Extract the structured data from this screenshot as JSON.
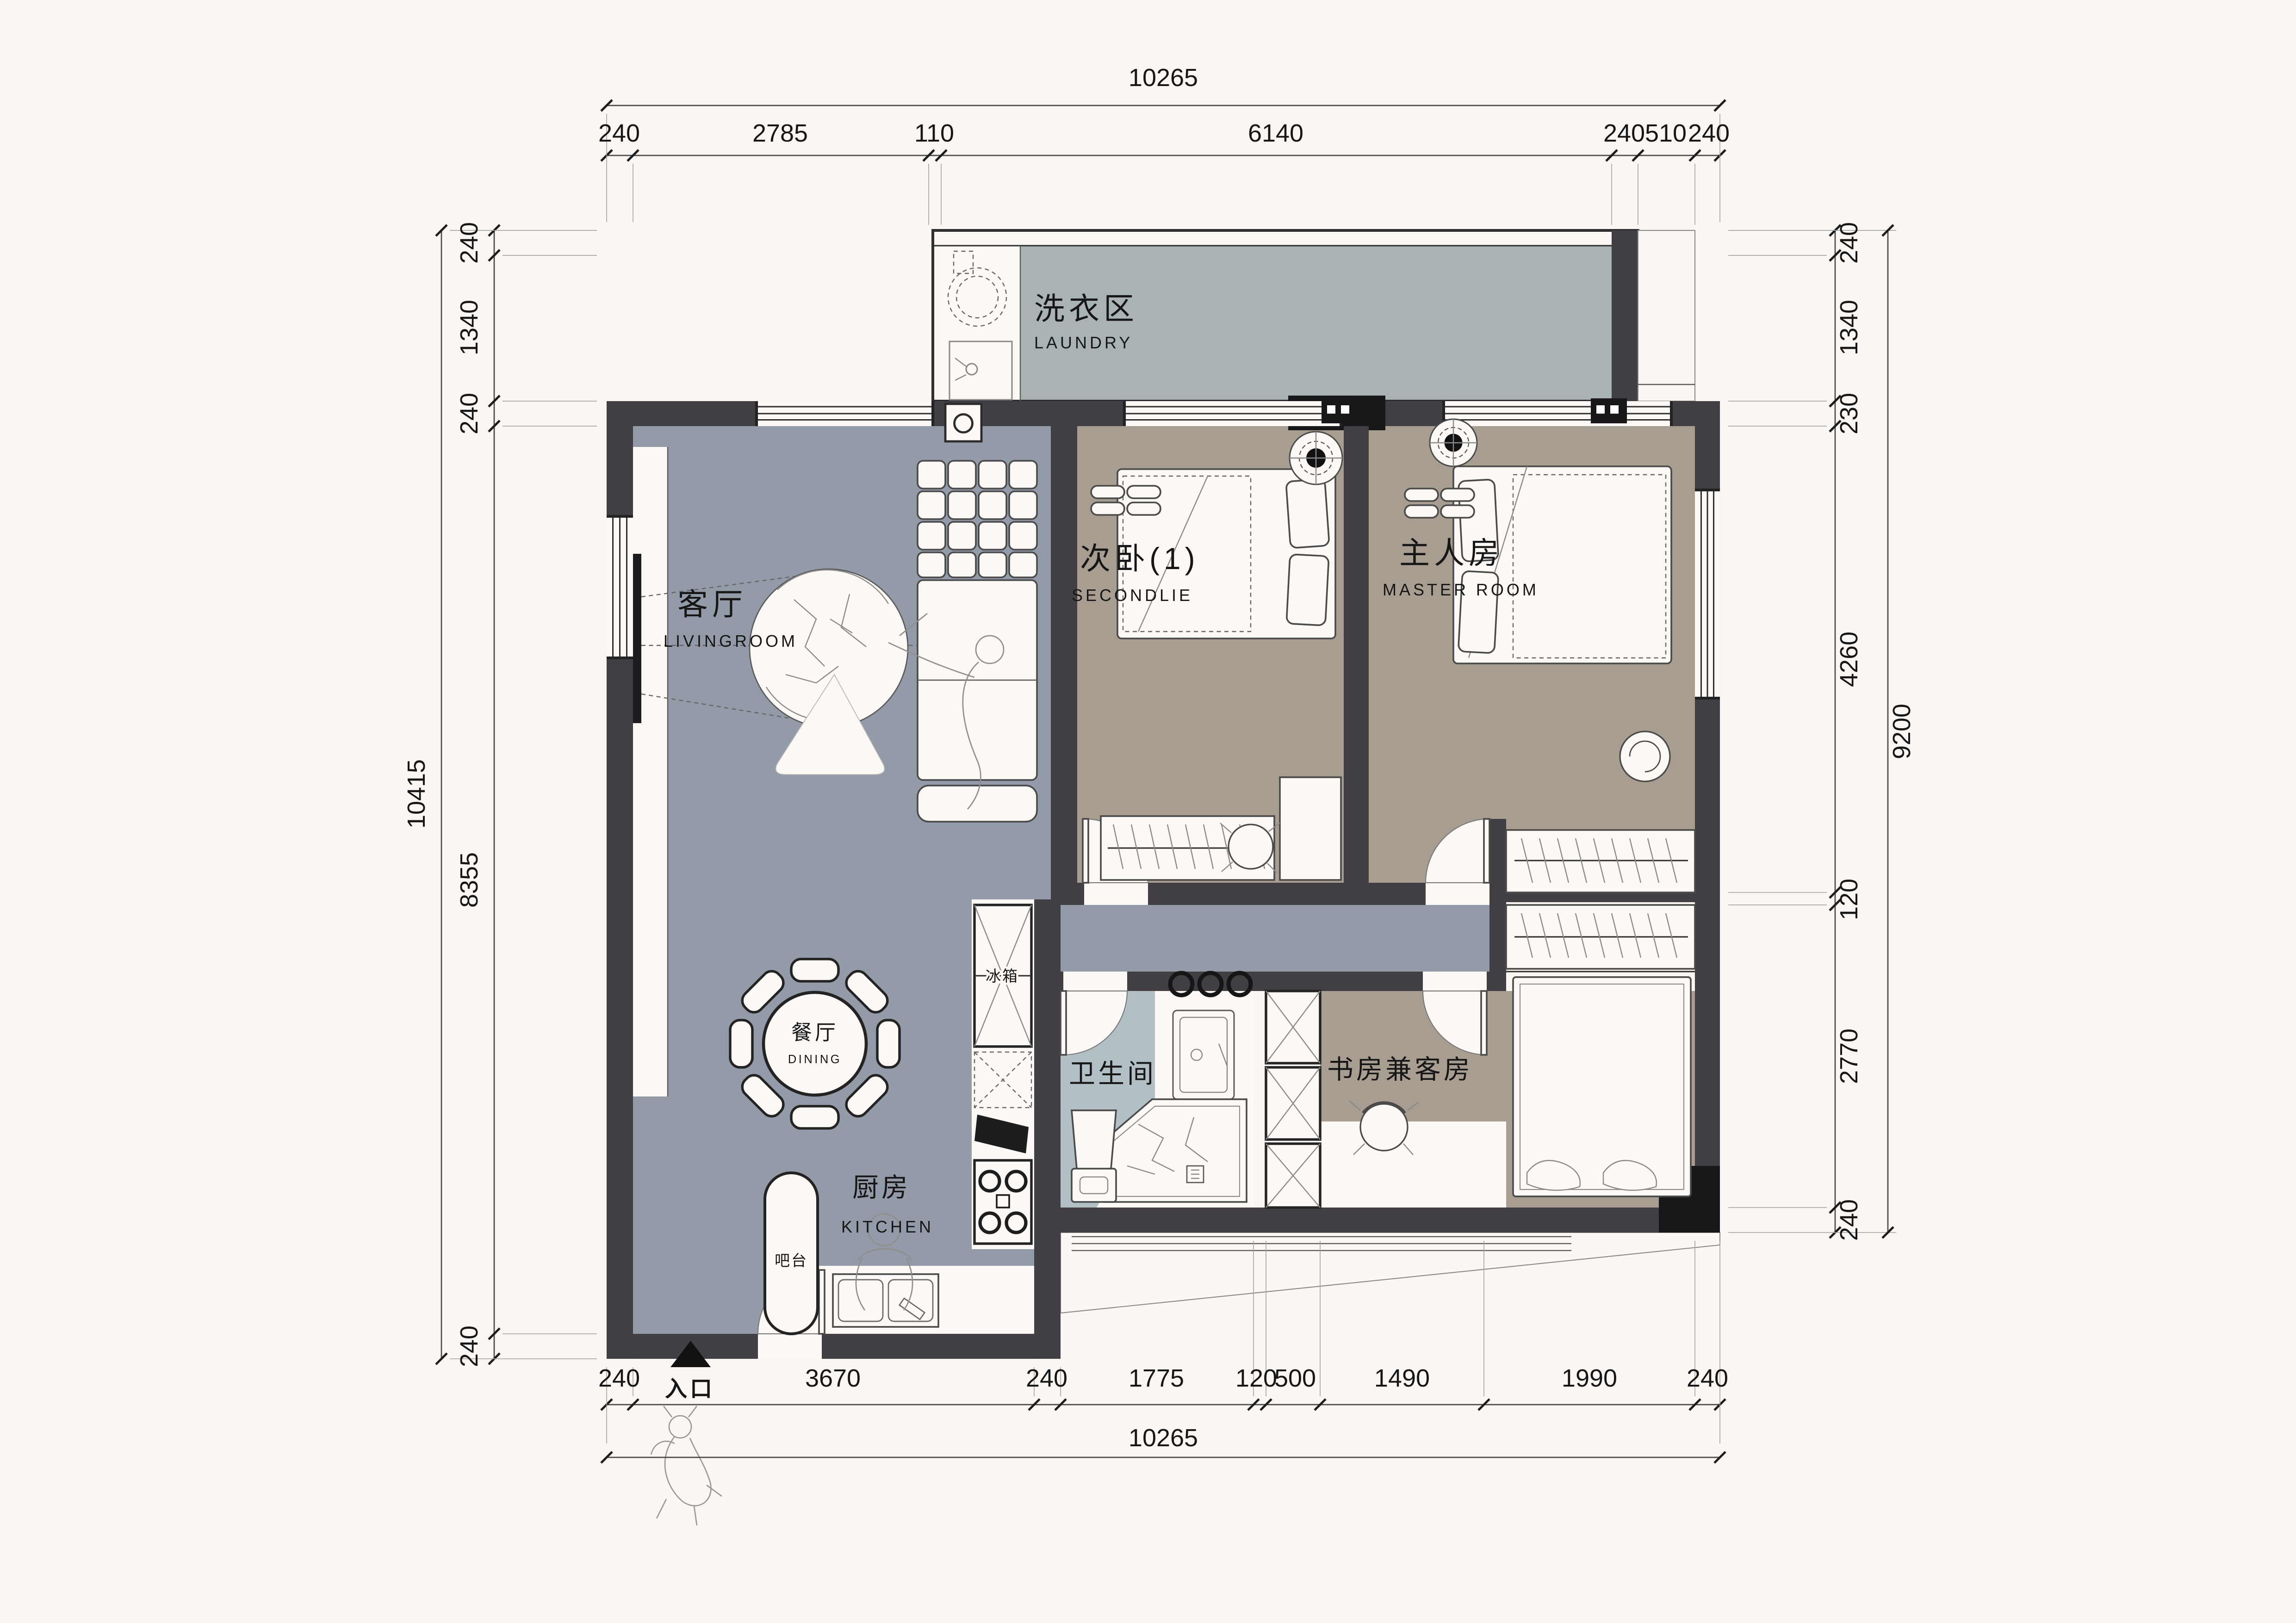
{
  "plan_title": "apartment-floor-plan",
  "colors": {
    "background": "#faf6f4",
    "wall": "#413f44",
    "black_block": "#18171a",
    "living_floor": "#939aa8",
    "laundry_floor": "#a9b2b4",
    "bedroom_floor": "#a79d91",
    "bathroom_floor": "#b2bfc5",
    "white_floor": "#fbf8f5"
  },
  "rooms": {
    "laundry": {
      "zh": "洗衣区",
      "en": "LAUNDRY"
    },
    "living": {
      "zh": "客厅",
      "en": "LIVINGROOM"
    },
    "second_bedroom": {
      "zh": "次卧(1)",
      "en": "SECONDLIE"
    },
    "master_bedroom": {
      "zh": "主人房",
      "en": "MASTER ROOM"
    },
    "dining": {
      "zh": "餐厅",
      "en": "DINING"
    },
    "kitchen": {
      "zh": "厨房",
      "en": "KITCHEN"
    },
    "bathroom": {
      "zh": "卫生间"
    },
    "study": {
      "zh": "书房兼客房"
    },
    "bar": {
      "zh": "吧台"
    },
    "fridge": {
      "zh": "冰箱"
    },
    "entrance": {
      "zh": "入口"
    }
  },
  "dims": {
    "top": {
      "overall": "10265",
      "segments": [
        "240",
        "2785",
        "110",
        "6140",
        "240",
        "510",
        "240"
      ]
    },
    "bottom": {
      "overall": "10265",
      "segments": [
        "240",
        "3670",
        "240",
        "1775",
        "120",
        "500",
        "1490",
        "1990",
        "240"
      ]
    },
    "left": {
      "overall": "10415",
      "segments": [
        "240",
        "1340",
        "240",
        "8355",
        "240"
      ]
    },
    "right": {
      "overall": "9200",
      "segments": [
        "240",
        "1340",
        "230",
        "4260",
        "120",
        "2770",
        "240"
      ]
    }
  }
}
